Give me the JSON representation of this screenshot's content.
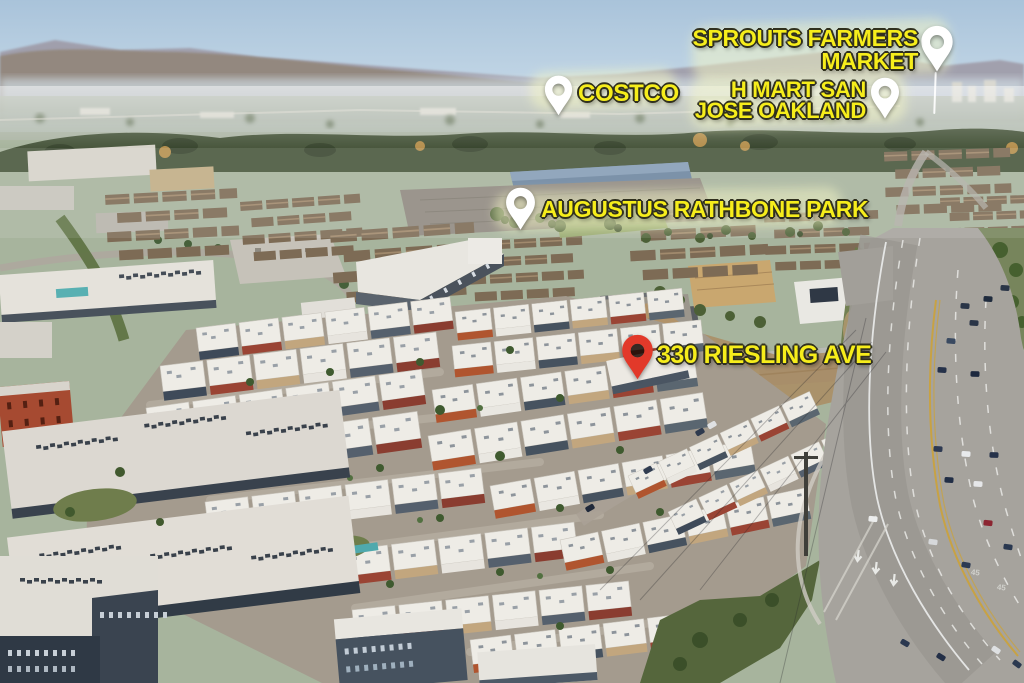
{
  "annotations": {
    "sprouts": {
      "line1": "SPROUTS FARMERS",
      "line2": "MARKET"
    },
    "costco": {
      "label": "COSTCO"
    },
    "hmart": {
      "line1": "H MART SAN",
      "line2": "JOSE OAKLAND"
    },
    "park": {
      "label": "AUGUSTUS RATHBONE PARK"
    },
    "subject": {
      "label": "330 RIESLING AVE"
    }
  },
  "road": {
    "speed_marking": "45"
  },
  "style": {
    "label_yellow": "#F6ED1B",
    "label_outline": "#30301E",
    "highlight_band": "rgba(246,248,197,0.5)",
    "pin_white": "#FFFFFF",
    "pin_red": "#E2392A"
  }
}
